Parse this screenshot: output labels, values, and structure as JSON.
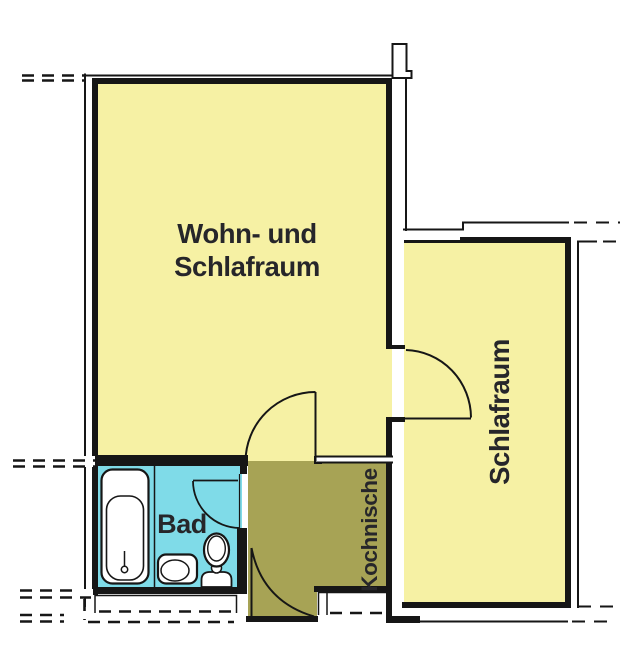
{
  "plan": {
    "rooms": {
      "living": {
        "label": [
          "Wohn- und",
          "Schlafraum"
        ],
        "color": "#f6f1a4"
      },
      "bedroom": {
        "label": "Schlafraum",
        "color": "#f6f1a4"
      },
      "bath": {
        "label": "Bad",
        "color": "#7fdbe8"
      },
      "kitchenette": {
        "label": "Kochnische",
        "color": "#a7a355"
      }
    },
    "colors": {
      "wall": "#161616",
      "label_text": "#26262a",
      "background": "#ffffff"
    },
    "fixtures": [
      "bathtub",
      "washbasin",
      "toilet"
    ]
  }
}
